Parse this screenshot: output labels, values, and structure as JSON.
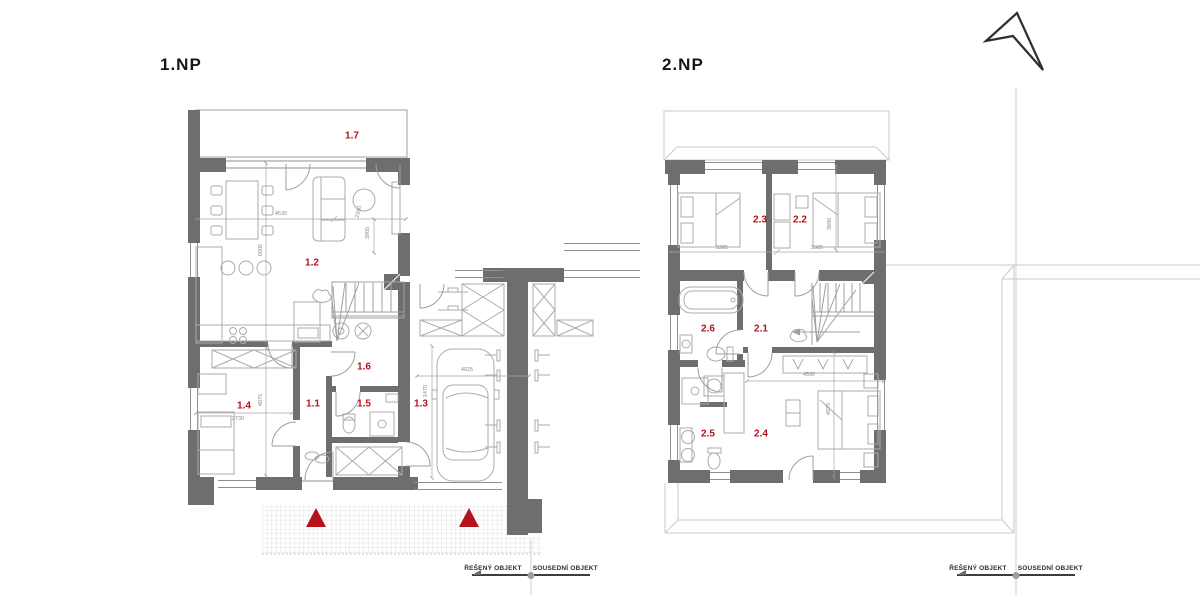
{
  "floor1": {
    "title": "1.NP",
    "rooms": [
      {
        "id": "1.7"
      },
      {
        "id": "1.2"
      },
      {
        "id": "1.1"
      },
      {
        "id": "1.3"
      },
      {
        "id": "1.4"
      },
      {
        "id": "1.5"
      },
      {
        "id": "1.6"
      }
    ],
    "dimensions": [
      {
        "text": "4530"
      },
      {
        "text": "2350"
      },
      {
        "text": "3905"
      },
      {
        "text": "6005"
      },
      {
        "text": "2730"
      },
      {
        "text": "4075"
      },
      {
        "text": "4025"
      },
      {
        "text": "1470"
      }
    ]
  },
  "floor2": {
    "title": "2.NP",
    "rooms": [
      {
        "id": "2.1"
      },
      {
        "id": "2.2"
      },
      {
        "id": "2.3"
      },
      {
        "id": "2.4"
      },
      {
        "id": "2.5"
      },
      {
        "id": "2.6"
      }
    ],
    "dimensions": [
      {
        "text": "3385"
      },
      {
        "text": "3385"
      },
      {
        "text": "3890"
      },
      {
        "text": "4590"
      },
      {
        "text": "4075"
      }
    ]
  },
  "legend": {
    "solved_label": "ŘEŠENÝ OBJEKT",
    "neighbor_label": "SOUSEDNÍ OBJEKT"
  },
  "icons": {
    "north_arrow": "north-arrow",
    "entrance_marker": "red-triangle"
  },
  "colors": {
    "accent_red": "#b5121b",
    "wall_gray": "#6e6e6e",
    "line_gray": "#9f9f9f"
  }
}
